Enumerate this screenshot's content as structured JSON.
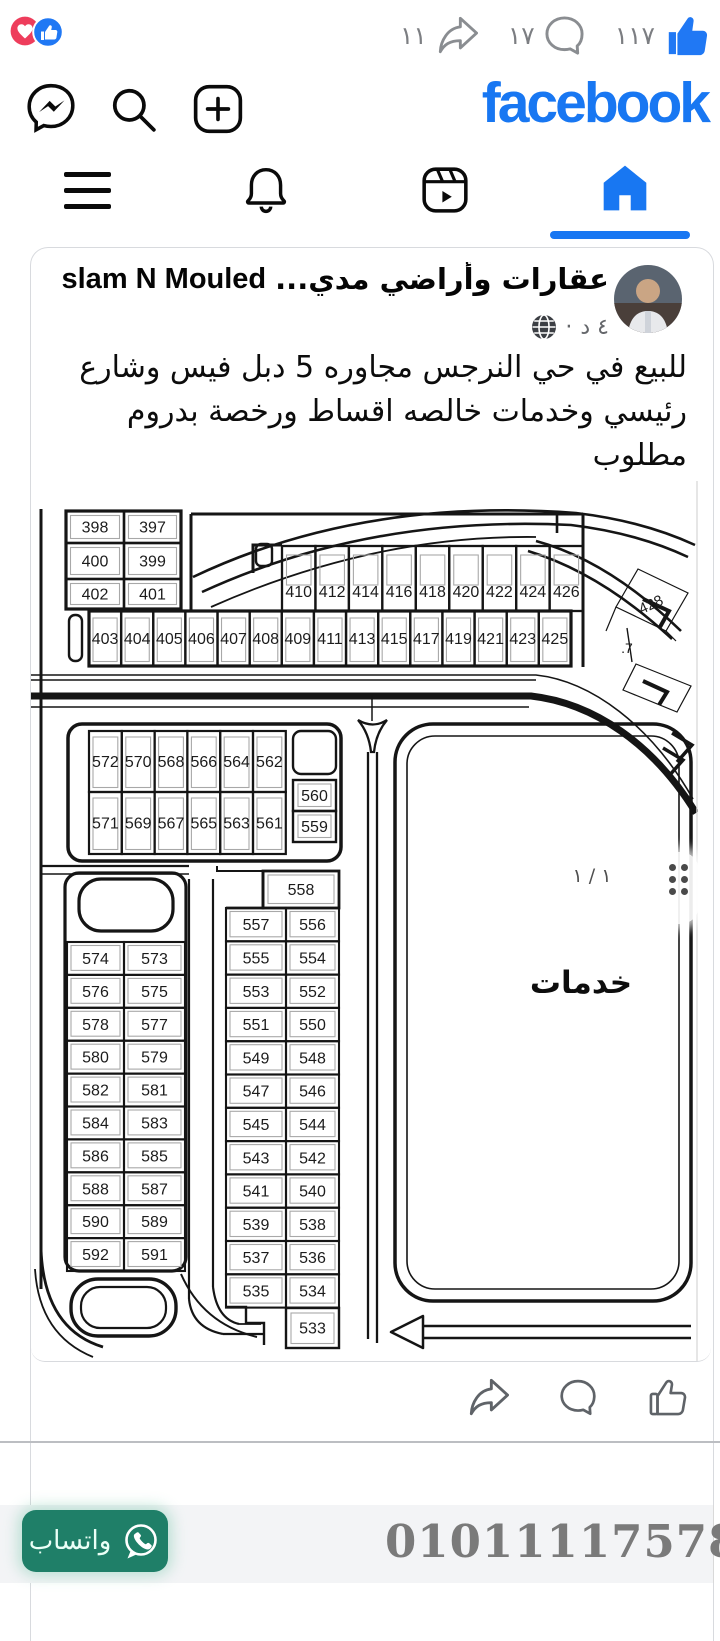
{
  "top_bar": {
    "share_count": "١١",
    "comment_count": "١٧",
    "like_count": "١١٧"
  },
  "header": {
    "logo_text": "facebook"
  },
  "post": {
    "group_name": "عقارات وأراضي مدي...",
    "author_name": "Eslam N Mouled",
    "header_arrow": "◄",
    "timestamp": "٤ د",
    "separator": "·",
    "lines": [
      "للبيع في حي النرجس مجاوره 5 دبل فيس وشارع",
      "رئيسي وخدمات خالصه اقساط ورخصة بدروم مطلوب",
      "01005006498"
    ]
  },
  "map": {
    "services_label": "خدمات",
    "page_indicator": "١ / ١",
    "rotated_plot_label": "428",
    "fragment_label": ".7",
    "top_left_rows": [
      [
        "398",
        "397"
      ],
      [
        "400",
        "399"
      ],
      [
        "402",
        "401"
      ]
    ],
    "strip_top": [
      "410",
      "412",
      "414",
      "416",
      "418",
      "420",
      "422",
      "424",
      "426"
    ],
    "strip_bottom": [
      "403",
      "404",
      "405",
      "406",
      "407",
      "408",
      "409",
      "411",
      "413",
      "415",
      "417",
      "419",
      "421",
      "423",
      "425"
    ],
    "mid_top": [
      "572",
      "570",
      "568",
      "566",
      "564",
      "562"
    ],
    "mid_bottom": [
      "571",
      "569",
      "567",
      "565",
      "563",
      "561"
    ],
    "mid_right": [
      "560",
      "559"
    ],
    "left_block_rows": [
      [
        "574",
        "573"
      ],
      [
        "576",
        "575"
      ],
      [
        "578",
        "577"
      ],
      [
        "580",
        "579"
      ],
      [
        "582",
        "581"
      ],
      [
        "584",
        "583"
      ],
      [
        "586",
        "585"
      ],
      [
        "588",
        "587"
      ],
      [
        "590",
        "589"
      ],
      [
        "592",
        "591"
      ]
    ],
    "right_block_top": "558",
    "right_block_rows": [
      [
        "557",
        "556"
      ],
      [
        "555",
        "554"
      ],
      [
        "553",
        "552"
      ],
      [
        "551",
        "550"
      ],
      [
        "549",
        "548"
      ],
      [
        "547",
        "546"
      ],
      [
        "545",
        "544"
      ],
      [
        "543",
        "542"
      ],
      [
        "541",
        "540"
      ],
      [
        "539",
        "538"
      ],
      [
        "537",
        "536"
      ],
      [
        "535",
        "534"
      ]
    ],
    "right_block_bottom": "533"
  },
  "footer": {
    "whatsapp_label": "واتساب",
    "phone_number": "01011117578"
  },
  "colors": {
    "facebook_blue": "#1877F2",
    "whatsapp_green": "#1f7f68",
    "heart_red": "#EE3D5C"
  }
}
